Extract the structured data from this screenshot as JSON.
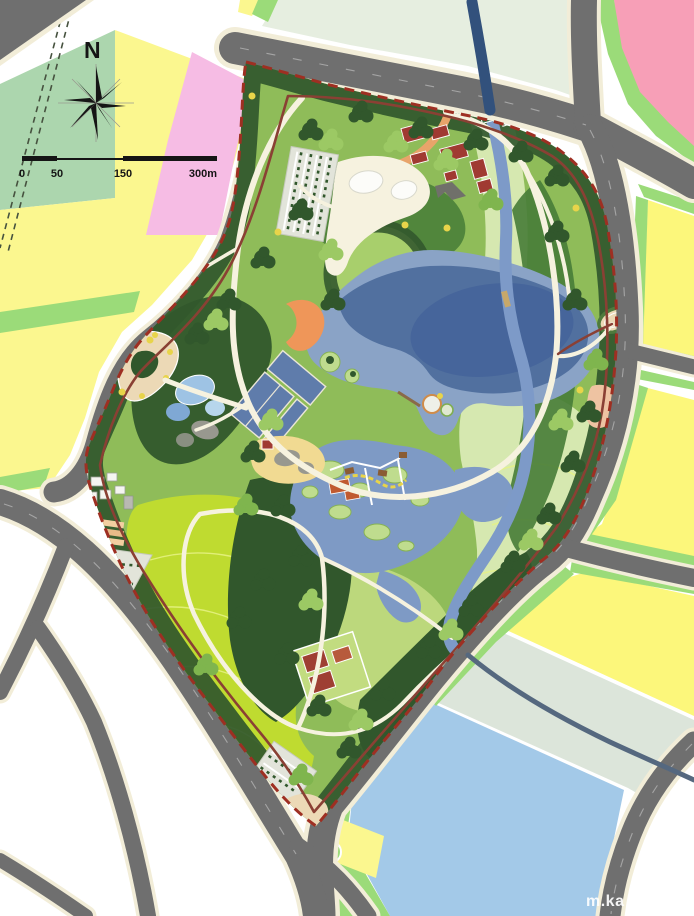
{
  "compass": {
    "label": "N"
  },
  "scale_bar": {
    "ticks": [
      "0",
      "50",
      "150",
      "300m"
    ]
  },
  "watermark": {
    "text": "m.ka"
  },
  "map": {
    "kind": "park-landscape-master-plan",
    "features": [
      "central-lake",
      "wetland-ponds",
      "stream-corridor",
      "great-lawn",
      "entry-plazas",
      "parking-lots",
      "sports-courts",
      "buildings",
      "tree-belts",
      "city-parcels",
      "road-network"
    ]
  },
  "colors": {
    "road_gray": "#6F6F6F",
    "road_casing": "#F2EDD8",
    "rail_dark": "#46523F",
    "parcel_sage": "#ACD6AE",
    "parcel_yellow": "#FBF78F",
    "parcel_yellow2": "#FCF77B",
    "parcel_pink": "#F6BCE4",
    "parcel_salmon": "#F79FB7",
    "parcel_pale": "#E6EEE0",
    "parcel_pale2": "#DCE5DA",
    "parcel_blue": "#A3C9E8",
    "green_strip": "#9BDB79",
    "park_base": "#8FBC59",
    "trees_dark": "#31572C",
    "trees_mid": "#477C37",
    "trees_light": "#7FB54E",
    "canopy_light": "#9CC964",
    "lawn_bright": "#BFDB30",
    "lawn_light": "#BCD87C",
    "meadow": "#D6E8B0",
    "contour": "#E6F285",
    "hill_green": "#A8CF6C",
    "earth_brown": "#7C4A26",
    "lake_edge": "#8AA3C6",
    "lake_mid": "#51709F",
    "lake_deep": "#44639A",
    "wetland_water": "#7E9AC5",
    "river": "#7D9AC8",
    "river_navy": "#32517C",
    "river_thin": "#55687F",
    "path_cream": "#F6F2DF",
    "trail_red": "#8A4034",
    "boundary_red": "#9E2F22",
    "drive_orange": "#E8A46A",
    "beach_orange": "#EF9659",
    "plaza_tan": "#ECD9B6",
    "sand": "#F1DA92",
    "rock_gray": "#98988F",
    "bldg_red": "#A03A32",
    "bldg_orange": "#C05A30",
    "court_green": "#3E6B41",
    "flower_yellow": "#E8D44A",
    "peach": "#EEC3A2",
    "parking_gray": "#E2E4DA",
    "white": "#FFFFFF",
    "ink": "#151515",
    "watermark_white": "#FFFFFF"
  }
}
